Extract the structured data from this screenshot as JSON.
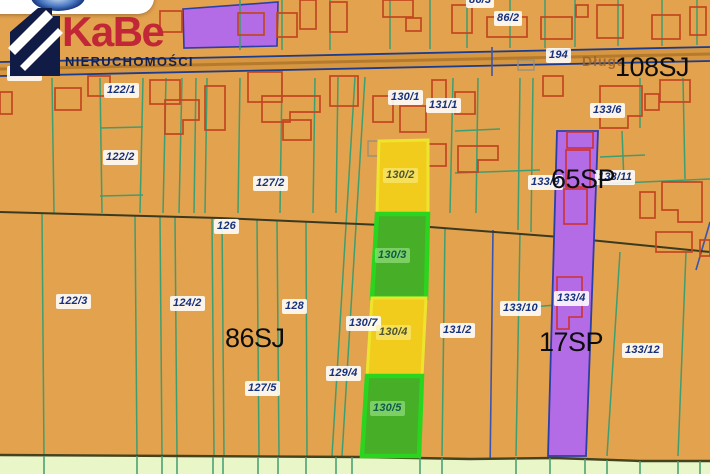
{
  "logo": {
    "brand": "KaBe",
    "subtitle": "NIERUCHOMOŚCI",
    "brand_color": "#c22737",
    "navy_color": "#15214d"
  },
  "map": {
    "street": {
      "label": "Długa",
      "x": 582,
      "y": 53
    },
    "zones": [
      {
        "label": "108SJ",
        "x": 615,
        "y": 53
      },
      {
        "label": "65SP",
        "x": 551,
        "y": 165
      },
      {
        "label": "86SJ",
        "x": 225,
        "y": 324
      },
      {
        "label": "17SP",
        "x": 539,
        "y": 328
      }
    ],
    "parcel_labels": [
      {
        "text": "121/1",
        "x": 7,
        "y": 66
      },
      {
        "text": "122/1",
        "x": 104,
        "y": 83
      },
      {
        "text": "86/3",
        "x": 466,
        "y": -7
      },
      {
        "text": "86/2",
        "x": 494,
        "y": 11
      },
      {
        "text": "194",
        "x": 546,
        "y": 48
      },
      {
        "text": "130/1",
        "x": 388,
        "y": 90
      },
      {
        "text": "131/1",
        "x": 426,
        "y": 98
      },
      {
        "text": "133/6",
        "x": 590,
        "y": 103
      },
      {
        "text": "122/2",
        "x": 103,
        "y": 150
      },
      {
        "text": "127/2",
        "x": 253,
        "y": 176
      },
      {
        "text": "133/9",
        "x": 528,
        "y": 175
      },
      {
        "text": "133/11",
        "x": 595,
        "y": 170
      },
      {
        "text": "126",
        "x": 214,
        "y": 219
      },
      {
        "text": "122/3",
        "x": 56,
        "y": 294
      },
      {
        "text": "124/2",
        "x": 170,
        "y": 296
      },
      {
        "text": "128",
        "x": 282,
        "y": 299
      },
      {
        "text": "133/10",
        "x": 500,
        "y": 301
      },
      {
        "text": "133/4",
        "x": 554,
        "y": 291
      },
      {
        "text": "130/7",
        "x": 346,
        "y": 316
      },
      {
        "text": "131/2",
        "x": 440,
        "y": 323
      },
      {
        "text": "133/12",
        "x": 622,
        "y": 343
      },
      {
        "text": "129/4",
        "x": 326,
        "y": 366
      },
      {
        "text": "127/5",
        "x": 245,
        "y": 381
      }
    ],
    "highlight_labels": [
      {
        "text": "130/2",
        "x": 383,
        "y": 168,
        "variant": "yellow"
      },
      {
        "text": "130/3",
        "x": 375,
        "y": 248,
        "variant": "green"
      },
      {
        "text": "130/4",
        "x": 376,
        "y": 325,
        "variant": "yellow"
      },
      {
        "text": "130/5",
        "x": 370,
        "y": 401,
        "variant": "green"
      }
    ],
    "highlight_parcels": [
      {
        "id": "130/2",
        "color": "yellow"
      },
      {
        "id": "130/3",
        "color": "green"
      },
      {
        "id": "130/4",
        "color": "yellow"
      },
      {
        "id": "130/5",
        "color": "green"
      }
    ],
    "colors": {
      "land": "#e2a24e",
      "road_fill": "#d69740",
      "road_border": "#1c3c8e",
      "boundary_teal": "#3f9d72",
      "boundary_blue": "#3a55b0",
      "building_outline": "#c2461f",
      "purple_parcel": "#b46ce6",
      "purple_border": "#2b3fa8",
      "highlight_yellow": "#f1cc1d",
      "highlight_yellow_border": "#eee42e",
      "highlight_green": "#46ae27",
      "highlight_green_border": "#2ad51f",
      "field_green": "#e9f6c8",
      "label_navy": "#15317e"
    }
  }
}
